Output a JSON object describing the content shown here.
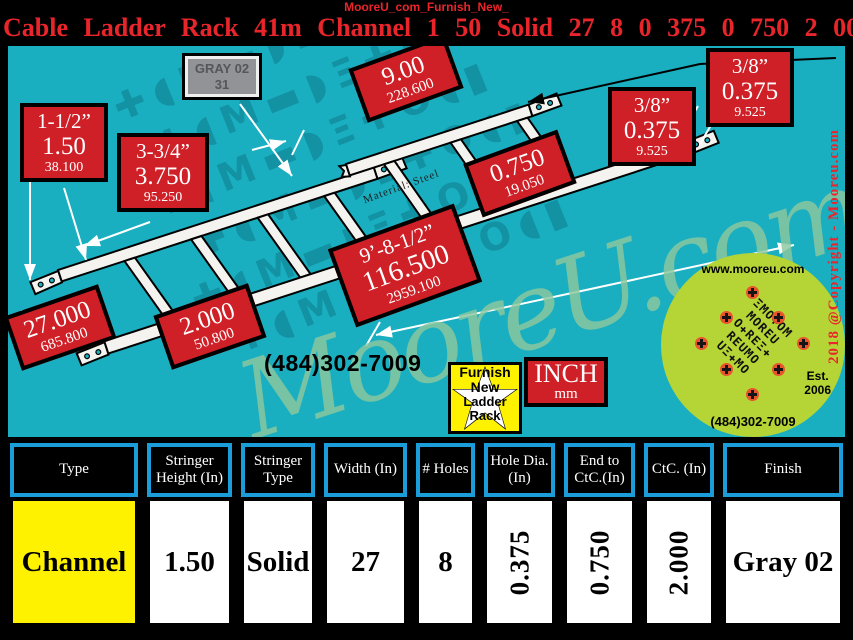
{
  "header": {
    "watermark": "MooreU_com_Furnish_New_",
    "title": "Cable Ladder Rack 41m Channel 1 50 Solid 27 8 0 375 0 750 2 000 Gray 02"
  },
  "diagram": {
    "gray_tag": {
      "line1": "GRAY 02",
      "line2": "31"
    },
    "material_note": "Material: Steel",
    "phone": "(484)302-7009",
    "badge": {
      "line1": "Furnish",
      "line2": "New",
      "line3": "Ladder",
      "line4": "Rack"
    },
    "units": {
      "primary": "INCH",
      "secondary": "mm"
    },
    "copyright": "2018 @Copyright - Mooreu.com",
    "watermark": "MooreU.com",
    "bg_pattern_row": "✚◖M▬◗Ξ✚O◖▮",
    "logo": {
      "url": "www.mooreu.com",
      "phone": "(484)302-7009",
      "est_line1": "Est.",
      "est_line2": "2006",
      "pattern_rows": [
        "ΞMO✚OM",
        "MOREU",
        "O✚REΞ✚",
        "REUMO",
        "UΞ✚MO"
      ]
    },
    "dims": [
      {
        "l1": "1-1/2”",
        "l2": "1.50",
        "l3": "38.100"
      },
      {
        "l1": "3-3/4”",
        "l2": "3.750",
        "l3": "95.250"
      },
      {
        "l1": "9.00",
        "l2": "228.600"
      },
      {
        "l1": "3/8”",
        "l2": "0.375",
        "l3": "9.525"
      },
      {
        "l1": "3/8”",
        "l2": "0.375",
        "l3": "9.525"
      },
      {
        "l1": "0.750",
        "l2": "19.050"
      },
      {
        "l1": "9’-8-1/2”",
        "l2": "116.500",
        "l3": "2959.100"
      },
      {
        "l1": "27.000",
        "l2": "685.800"
      },
      {
        "l1": "2.000",
        "l2": "50.800"
      }
    ]
  },
  "table": {
    "headers": [
      "Type",
      "Stringer Height (In)",
      "Stringer Type",
      "Width (In)",
      "# Holes",
      "Hole Dia. (In)",
      "End to CtC.(In)",
      "CtC. (In)",
      "Finish"
    ],
    "row": [
      "Channel",
      "1.50",
      "Solid",
      "27",
      "8",
      "0.375",
      "0.750",
      "2.000",
      "Gray 02"
    ]
  },
  "colors": {
    "accent_red": "#d02027",
    "teal": "#19afc0",
    "table_border_blue": "#1b9dd9",
    "highlight_yellow": "#fff200",
    "logo_green": "#b5d435"
  }
}
